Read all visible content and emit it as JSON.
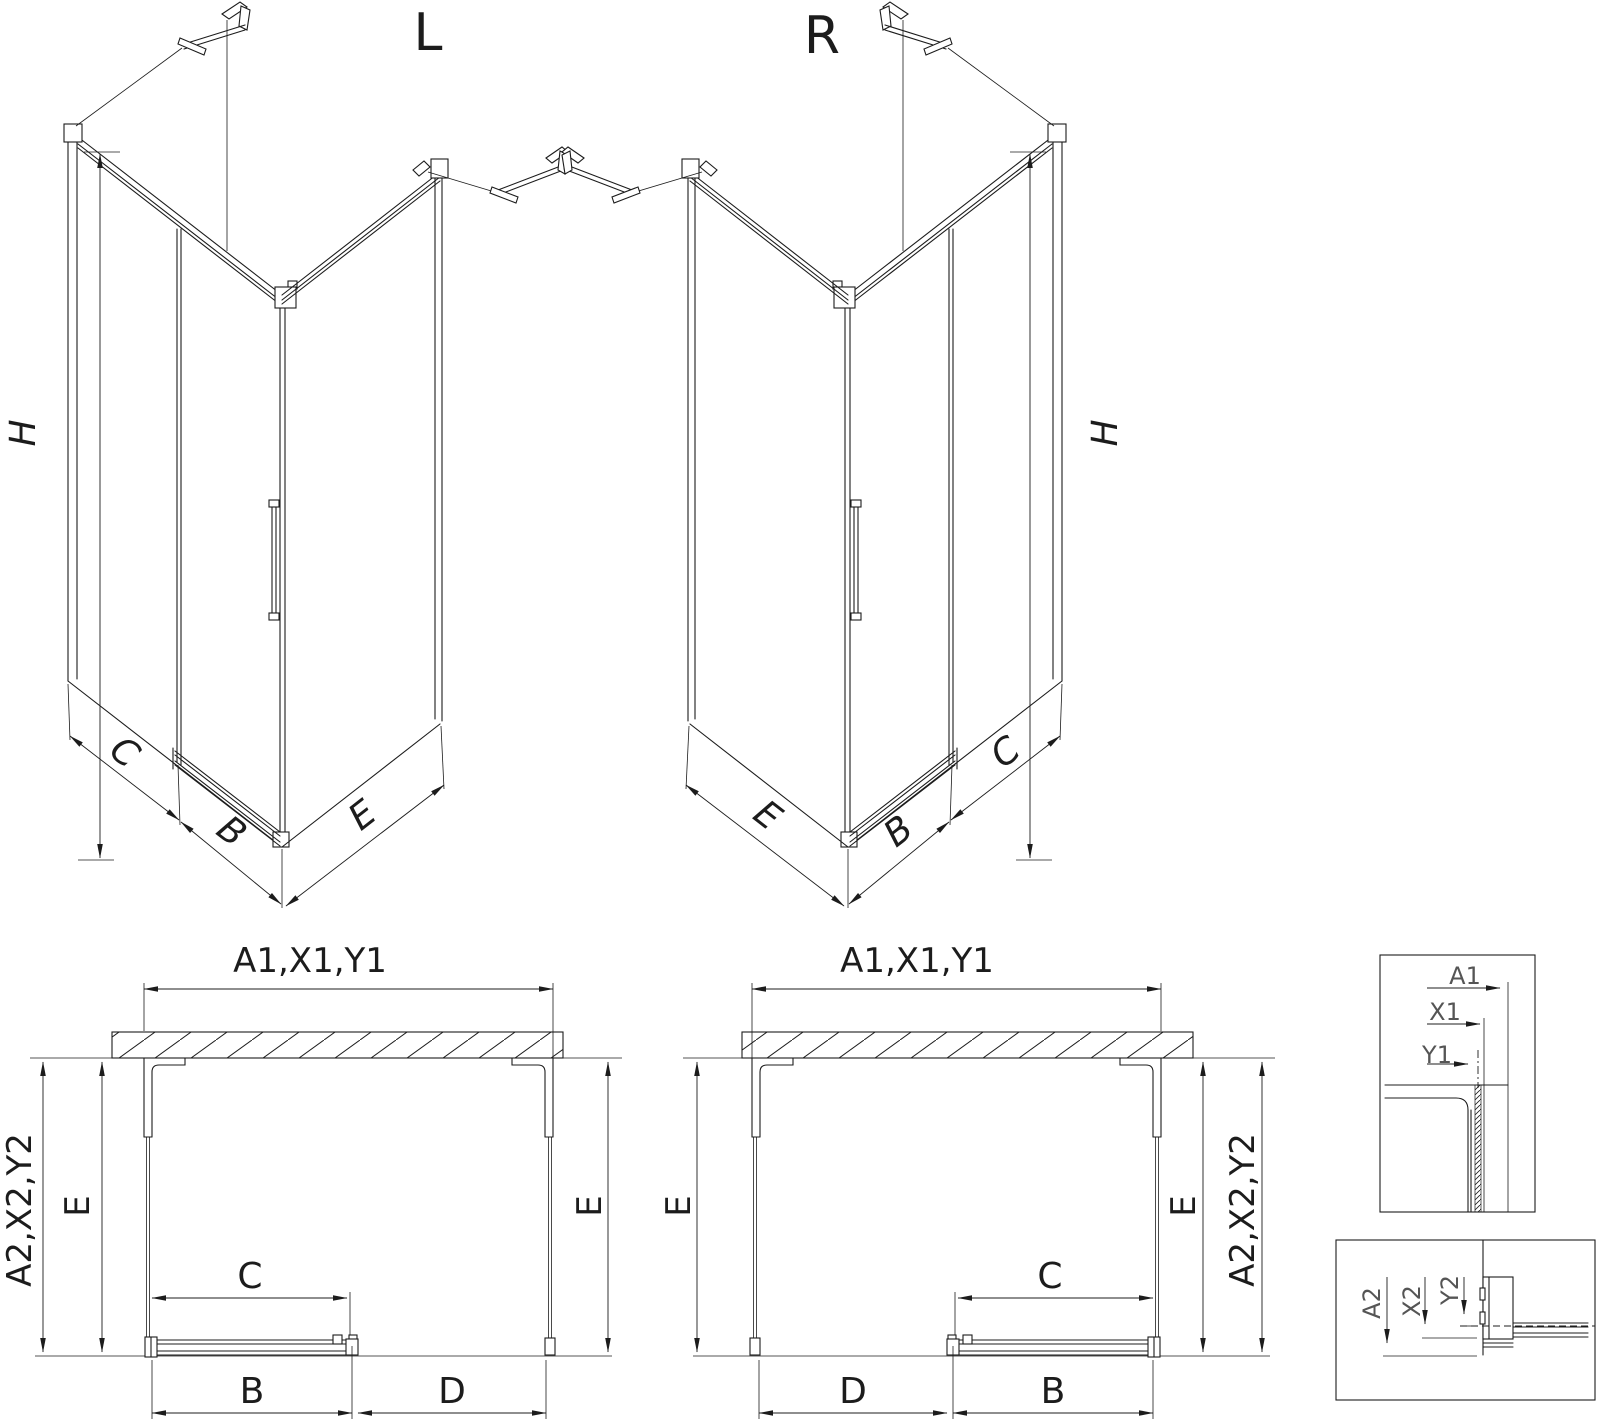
{
  "labels": {
    "iso_left": {
      "title": "L",
      "height": "H",
      "panel_c": "C",
      "door_b": "B",
      "side_e": "E"
    },
    "iso_right": {
      "title": "R",
      "height": "H",
      "panel_c": "C",
      "door_b": "B",
      "side_e": "E"
    },
    "plan_left": {
      "width": "A1,X1,Y1",
      "depth": "A2,X2,Y2",
      "e_left": "E",
      "e_right": "E",
      "c": "C",
      "b": "B",
      "d": "D"
    },
    "plan_right": {
      "width": "A1,X1,Y1",
      "depth": "A2,X2,Y2",
      "e_left": "E",
      "e_right": "E",
      "c": "C",
      "b": "B",
      "d": "D"
    },
    "detail_width": {
      "a": "A1",
      "x": "X1",
      "y": "Y1"
    },
    "detail_depth": {
      "a": "A2",
      "x": "X2",
      "y": "Y2"
    }
  },
  "colors": {
    "line": "#1c1c1c",
    "dimension_text": "#1c1c1c",
    "detail_text": "#555555",
    "background": "#ffffff"
  }
}
